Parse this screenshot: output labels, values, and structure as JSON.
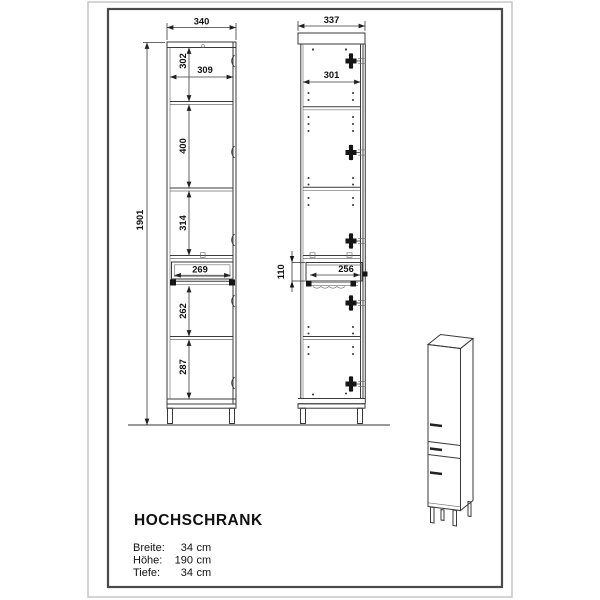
{
  "document": {
    "product_name": "HOCHSCHRANK",
    "specs": [
      {
        "label": "Breite:",
        "value": "34",
        "unit": "cm"
      },
      {
        "label": "Höhe:",
        "value": "190",
        "unit": "cm"
      },
      {
        "label": "Tiefe:",
        "value": "34",
        "unit": "cm"
      }
    ]
  },
  "front_view": {
    "overall_width_mm": "340",
    "overall_height_mm": "1901",
    "shelf_clear_width_mm": "309",
    "compartment_1_height_mm": "302",
    "compartment_2_height_mm": "400",
    "compartment_3_height_mm": "314",
    "drawer_front_width_mm": "269",
    "compartment_4_height_mm": "262",
    "compartment_5_height_mm": "287"
  },
  "side_view": {
    "overall_depth_mm": "337",
    "inner_depth_mm": "301",
    "drawer_front_height_mm": "110",
    "drawer_depth_mm": "256"
  }
}
